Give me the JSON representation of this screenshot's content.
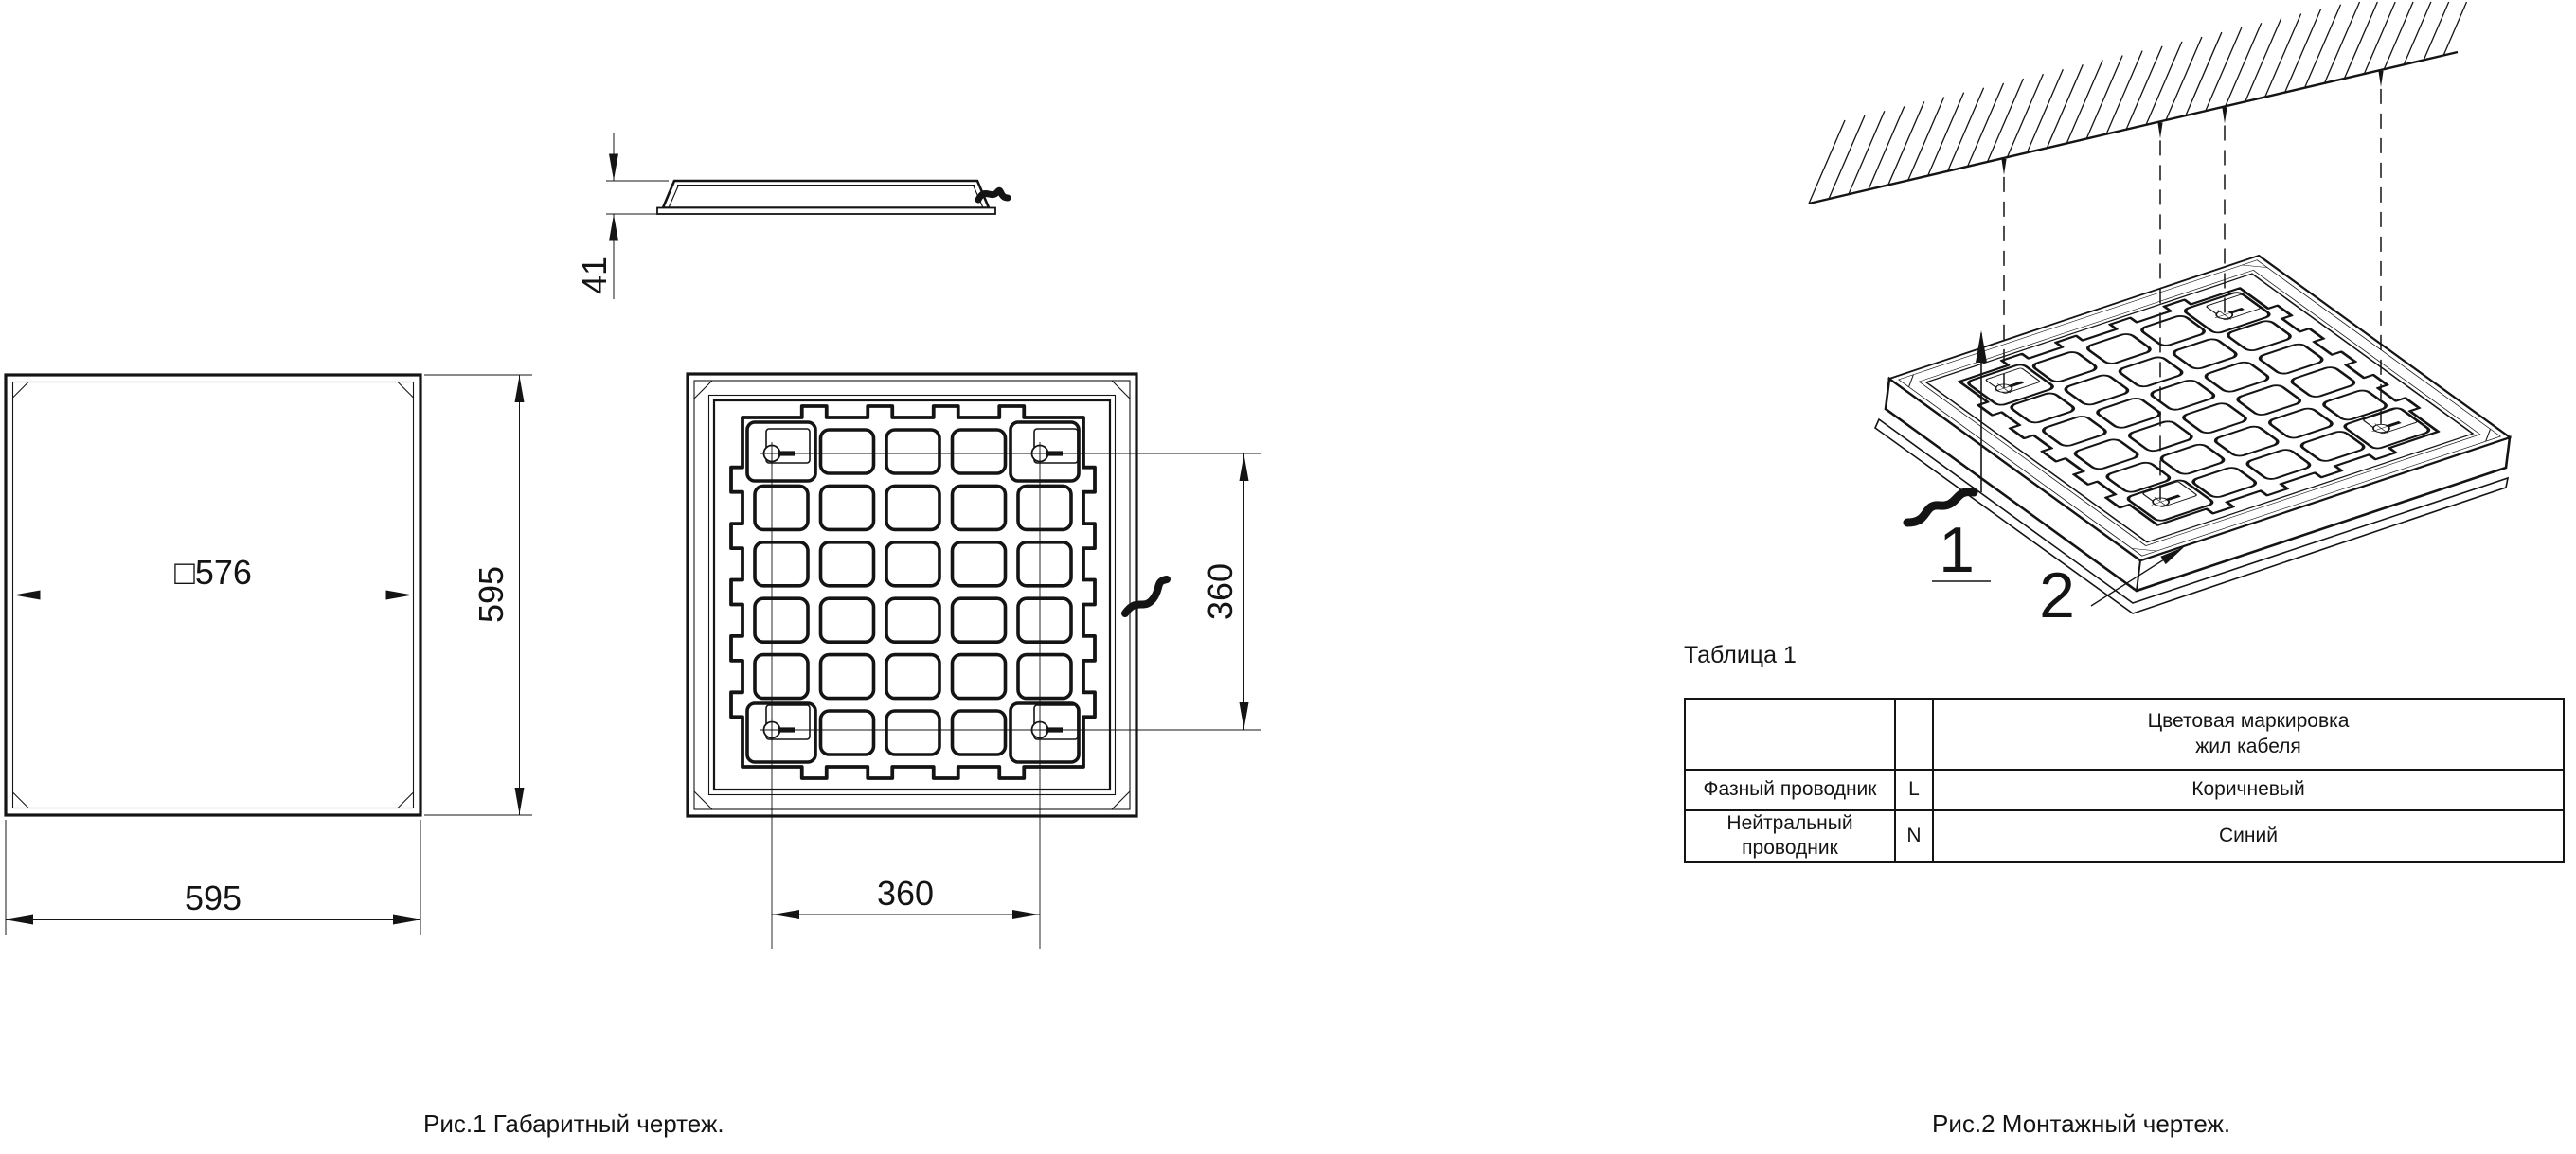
{
  "drawing": {
    "background": "#ffffff",
    "line_color": "#141414"
  },
  "figure1": {
    "caption": "Рис.1 Габаритный чертеж.",
    "front_view": {
      "dim_inner_width": "□576",
      "dim_height": "595",
      "dim_width": "595"
    },
    "side_view": {
      "dim_thickness": "41"
    },
    "rear_view": {
      "dim_mount_vertical": "360",
      "dim_mount_horizontal": "360"
    }
  },
  "figure2": {
    "caption": "Рис.2 Монтажный чертеж.",
    "callouts": {
      "suspension": "1",
      "luminaire": "2"
    }
  },
  "table1": {
    "title": "Таблица 1",
    "header": {
      "marking_line1": "Цветовая маркировка",
      "marking_line2": "жил кабеля"
    },
    "rows": [
      {
        "conductor": "Фазный проводник",
        "code": "L",
        "marking": "Коричневый"
      },
      {
        "conductor": "Нейтральный проводник",
        "code": "N",
        "marking": "Синий"
      }
    ]
  }
}
